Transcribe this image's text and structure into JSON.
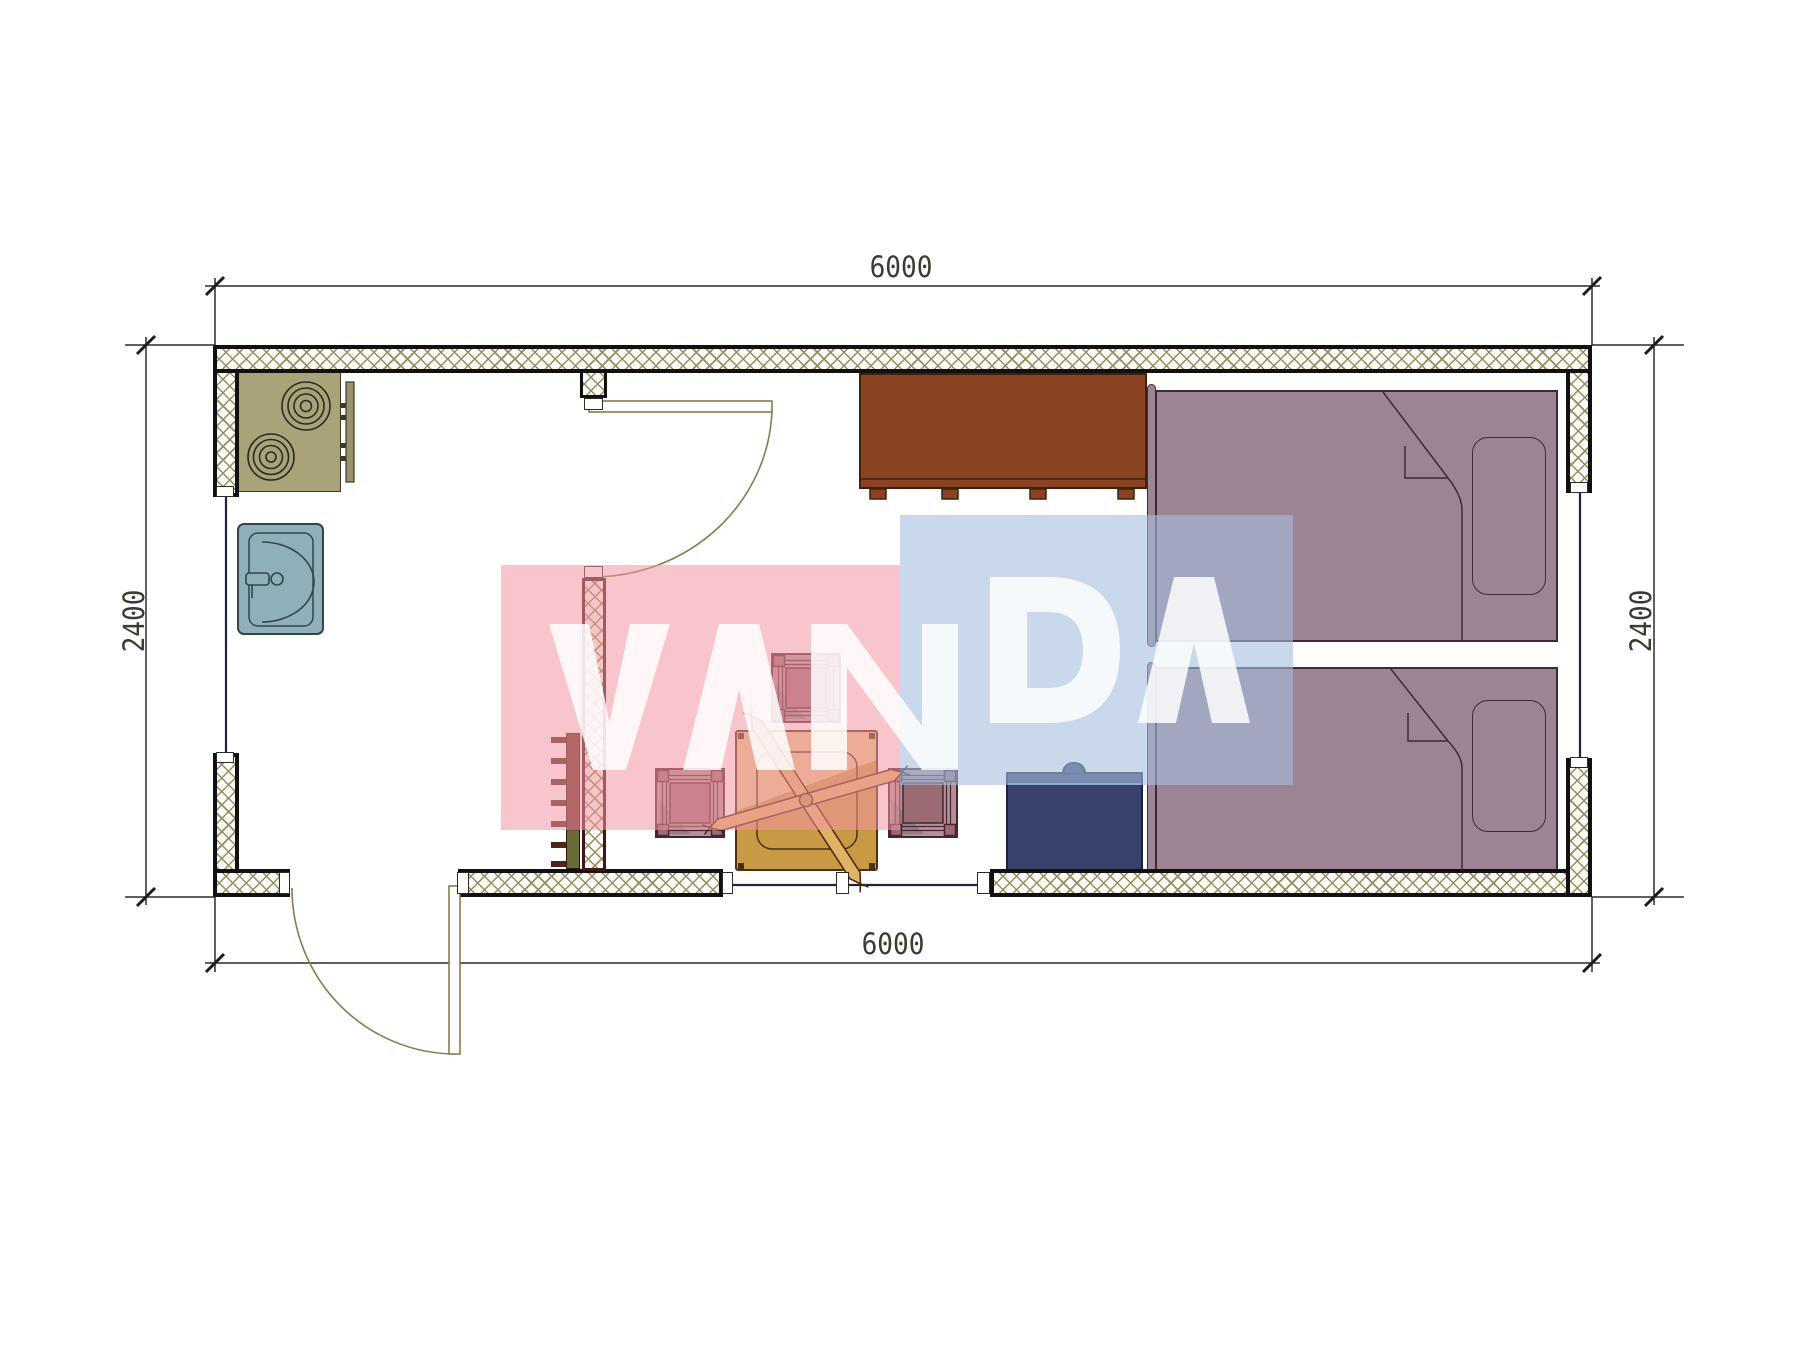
{
  "drawing": {
    "type": "architectural-floor-plan",
    "module_size_mm": "6000 x 2400",
    "dimensions": {
      "top": {
        "label": "6000"
      },
      "bottom": {
        "label": "6000"
      },
      "left": {
        "label": "2400"
      },
      "right": {
        "label": "2400"
      }
    },
    "watermark": {
      "text": "VANDA",
      "pink_block_color": "#f296a2",
      "blue_block_color": "#a5bedc",
      "letter_color": "#ffffff"
    },
    "walls": {
      "hatch_line_color": "#968b62",
      "outer_border_color": "#111111",
      "partition_border_color": "#431616",
      "window_line_color": "#23233f",
      "door_line_color": "#8a7a50"
    },
    "furniture": [
      {
        "name": "cooktop-two-burners",
        "color": "#a8a379"
      },
      {
        "name": "kitchen-side-panel",
        "color": "#98946a"
      },
      {
        "name": "sink",
        "color": "#8fb0b8"
      },
      {
        "name": "wardrobe",
        "color": "#8a4423"
      },
      {
        "name": "bed-upper",
        "color": "#9d8494"
      },
      {
        "name": "bed-lower",
        "color": "#9d8494"
      },
      {
        "name": "table-with-cross-base",
        "color": "#c89a45"
      },
      {
        "name": "stool-top",
        "color": "#9b6b74"
      },
      {
        "name": "stool-left",
        "color": "#9b6b74"
      },
      {
        "name": "stool-right",
        "color": "#9b6b74"
      },
      {
        "name": "bedside-chest",
        "color": "#39426b"
      },
      {
        "name": "radiator",
        "color": "#6b3226"
      }
    ],
    "dimension_style": {
      "text_color": "#3b3b33",
      "line_color": "#2b2b28"
    }
  }
}
